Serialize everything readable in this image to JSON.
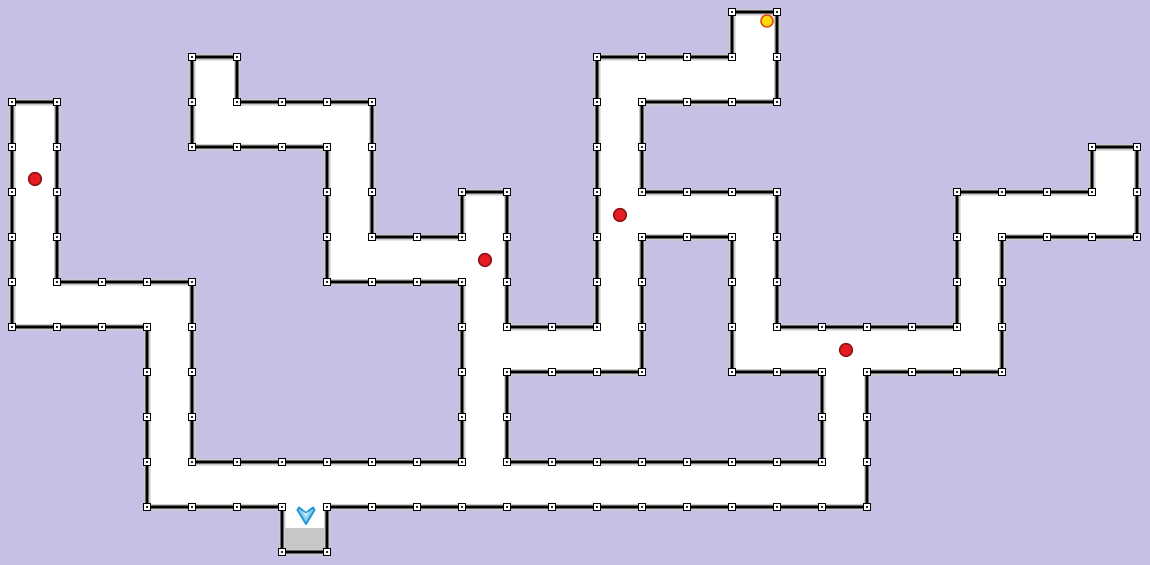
{
  "app": {
    "name": "maze-level-editor",
    "view": "level-canvas"
  },
  "canvas": {
    "width": 1150,
    "height": 565,
    "background": "#c6c0e4"
  },
  "maze": {
    "fill": "#ffffff",
    "wall_color": "#000000",
    "halo_color": "#cbcbcb",
    "wall_width": 2.8,
    "halo_width": 6.5,
    "grid_step": 45,
    "handle": {
      "size": 7,
      "fill": "#ffffff",
      "border": "#000000",
      "dot": "#2b2b2b"
    },
    "outer": [
      [
        192,
        57
      ],
      [
        237,
        57
      ],
      [
        237,
        102
      ],
      [
        372,
        102
      ],
      [
        372,
        237
      ],
      [
        462,
        237
      ],
      [
        462,
        192
      ],
      [
        507,
        192
      ],
      [
        507,
        327
      ],
      [
        597,
        327
      ],
      [
        597,
        57
      ],
      [
        732,
        57
      ],
      [
        732,
        12
      ],
      [
        777,
        12
      ],
      [
        777,
        102
      ],
      [
        642,
        102
      ],
      [
        642,
        192
      ],
      [
        777,
        192
      ],
      [
        777,
        327
      ],
      [
        957,
        327
      ],
      [
        957,
        192
      ],
      [
        1092,
        192
      ],
      [
        1092,
        147
      ],
      [
        1137,
        147
      ],
      [
        1137,
        237
      ],
      [
        1002,
        237
      ],
      [
        1002,
        372
      ],
      [
        867,
        372
      ],
      [
        867,
        507
      ],
      [
        327,
        507
      ],
      [
        327,
        552
      ],
      [
        282,
        552
      ],
      [
        282,
        507
      ],
      [
        147,
        507
      ],
      [
        147,
        327
      ],
      [
        12,
        327
      ],
      [
        12,
        102
      ],
      [
        57,
        102
      ],
      [
        57,
        282
      ],
      [
        192,
        282
      ],
      [
        192,
        462
      ],
      [
        462,
        462
      ],
      [
        462,
        282
      ],
      [
        327,
        282
      ],
      [
        327,
        147
      ],
      [
        192,
        147
      ]
    ],
    "hole": [
      [
        642,
        237
      ],
      [
        732,
        237
      ],
      [
        732,
        372
      ],
      [
        822,
        372
      ],
      [
        822,
        462
      ],
      [
        507,
        462
      ],
      [
        507,
        372
      ],
      [
        642,
        372
      ]
    ]
  },
  "entities": {
    "red_dots": [
      {
        "x": 35,
        "y": 179
      },
      {
        "x": 485,
        "y": 260
      },
      {
        "x": 620,
        "y": 215
      },
      {
        "x": 846,
        "y": 350
      }
    ],
    "red_dot_style": {
      "fill": "#e51c23",
      "stroke": "#8c1212",
      "r": 6.3,
      "stroke_width": 1.6
    },
    "goal_dot": {
      "x": 767,
      "y": 21,
      "fill": "#ffd90a",
      "stroke": "#e04a10",
      "r": 6,
      "stroke_width": 1.6
    },
    "ship": {
      "x": 306,
      "y": 516,
      "fill": "#8ccdf0",
      "highlight": "#cfeafa",
      "stroke": "#2196d6"
    },
    "landing_pad": {
      "x": 283.5,
      "y": 528,
      "width": 42,
      "height": 23,
      "fill": "#c7c7c7"
    }
  }
}
